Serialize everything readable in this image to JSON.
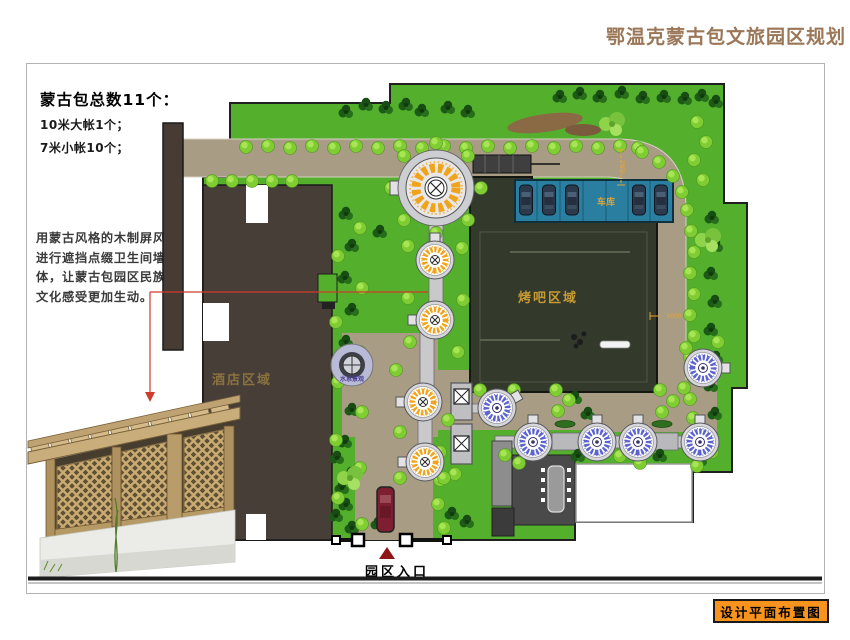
{
  "header": {
    "title": "鄂温克蒙古包文旅园区规划"
  },
  "notes": {
    "heading": "蒙古包总数11个：",
    "line1": "10米大帐1个；",
    "line2": "7米小帐10个；",
    "para1": "用蒙古风格的木制屏风",
    "para2": "进行遮挡点缀卫生间墙",
    "para3": "体，让蒙古包园区民族",
    "para4": "文化感受更加生动。"
  },
  "plan": {
    "hotel_label": "酒店区域",
    "bbq_label": "烤吧区域",
    "garage_label": "车库",
    "water_label": "水系景观",
    "entrance_label": "园区入口",
    "dim_vertical": "7800",
    "dim_horizontal": "5000"
  },
  "footer": {
    "caption": "设计平面布置图"
  },
  "colors": {
    "accent_orange": "#f8941d",
    "title_brown": "#9b7758",
    "annotation_red": "#cf3a2a",
    "grass_green": "#54b02c",
    "road_tan": "#a89d84",
    "garage_blue": "#2a7fa0",
    "yurt_yellow": "#f0a41c",
    "yurt_blue": "#5d63cd"
  }
}
